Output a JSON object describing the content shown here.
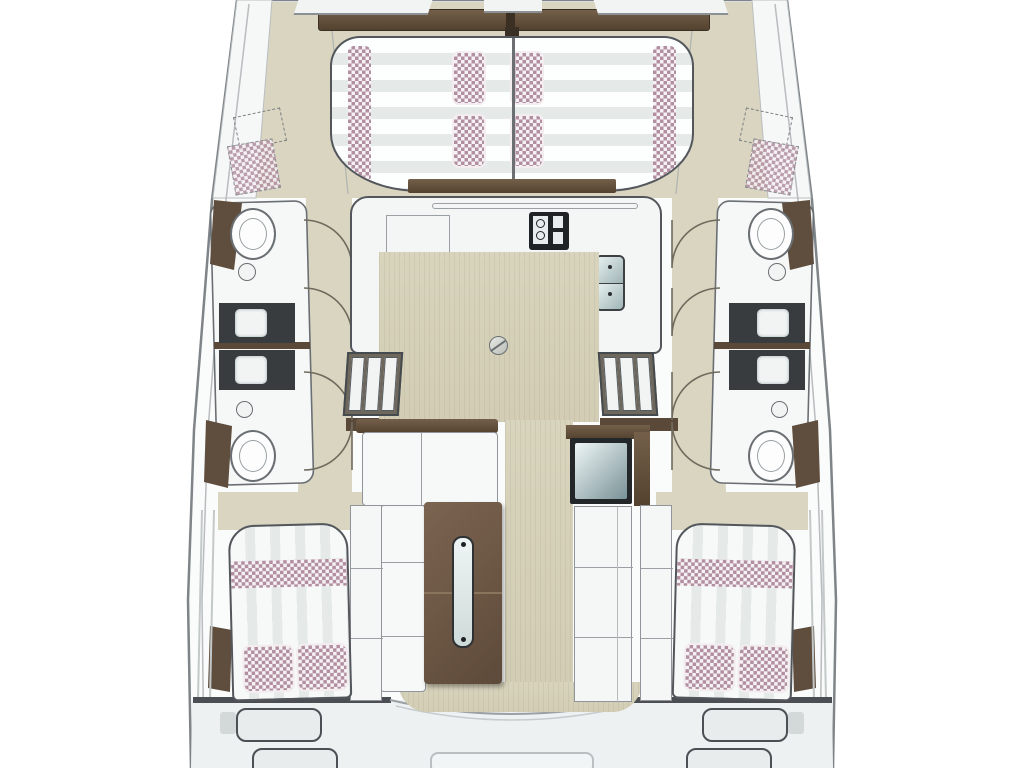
{
  "title": "Catamaran interior deck floor plan (top view)",
  "colors": {
    "page_bg": "#ffffff",
    "hull_fill": "#fafbfb",
    "hull_outline": "#7e8488",
    "deck_beige": "#d9d5c0",
    "floor_wood": "#d5d0b8",
    "wood_dark": "#53422f",
    "wood_mid": "#6e5947",
    "charcoal": "#383c3f",
    "fabric_mauve": "#b18fa0",
    "fabric_base": "#f6f1f3",
    "stripe_light": "#e5eae9",
    "surface_white": "#f5f7f7",
    "line_gray": "#6a6f73",
    "steel_teal": "#9fb4b6"
  },
  "features": {
    "foredeck": [
      "crossbeam",
      "sun-lounge",
      "lounge-bolsters",
      "lounge-pillows",
      "bow-hatch-port",
      "bow-hatch-starboard"
    ],
    "galley": [
      "u-counter",
      "stove",
      "double-sink",
      "counter-rail",
      "appliance-well",
      "floor-hatch"
    ],
    "companionways": [
      "steps-port",
      "steps-starboard",
      "door-swings"
    ],
    "saloon": [
      "l-sofa",
      "dining-table",
      "table-glass-inlay",
      "fridge-chart-seat",
      "bench-starboard"
    ],
    "port_hull": [
      "fwd-toilet",
      "fwd-sink",
      "shower-units",
      "aft-sink",
      "aft-toilet",
      "wardrobe",
      "aft-double-berth",
      "berth-pillows"
    ],
    "starboard_hull": [
      "fwd-toilet",
      "fwd-sink",
      "shower-units",
      "aft-sink",
      "aft-toilet",
      "wardrobe",
      "aft-double-berth",
      "berth-pillows"
    ],
    "transom": [
      "swim-steps-port",
      "swim-steps-starboard",
      "aft-platform",
      "cockpit-sole-curve"
    ]
  }
}
